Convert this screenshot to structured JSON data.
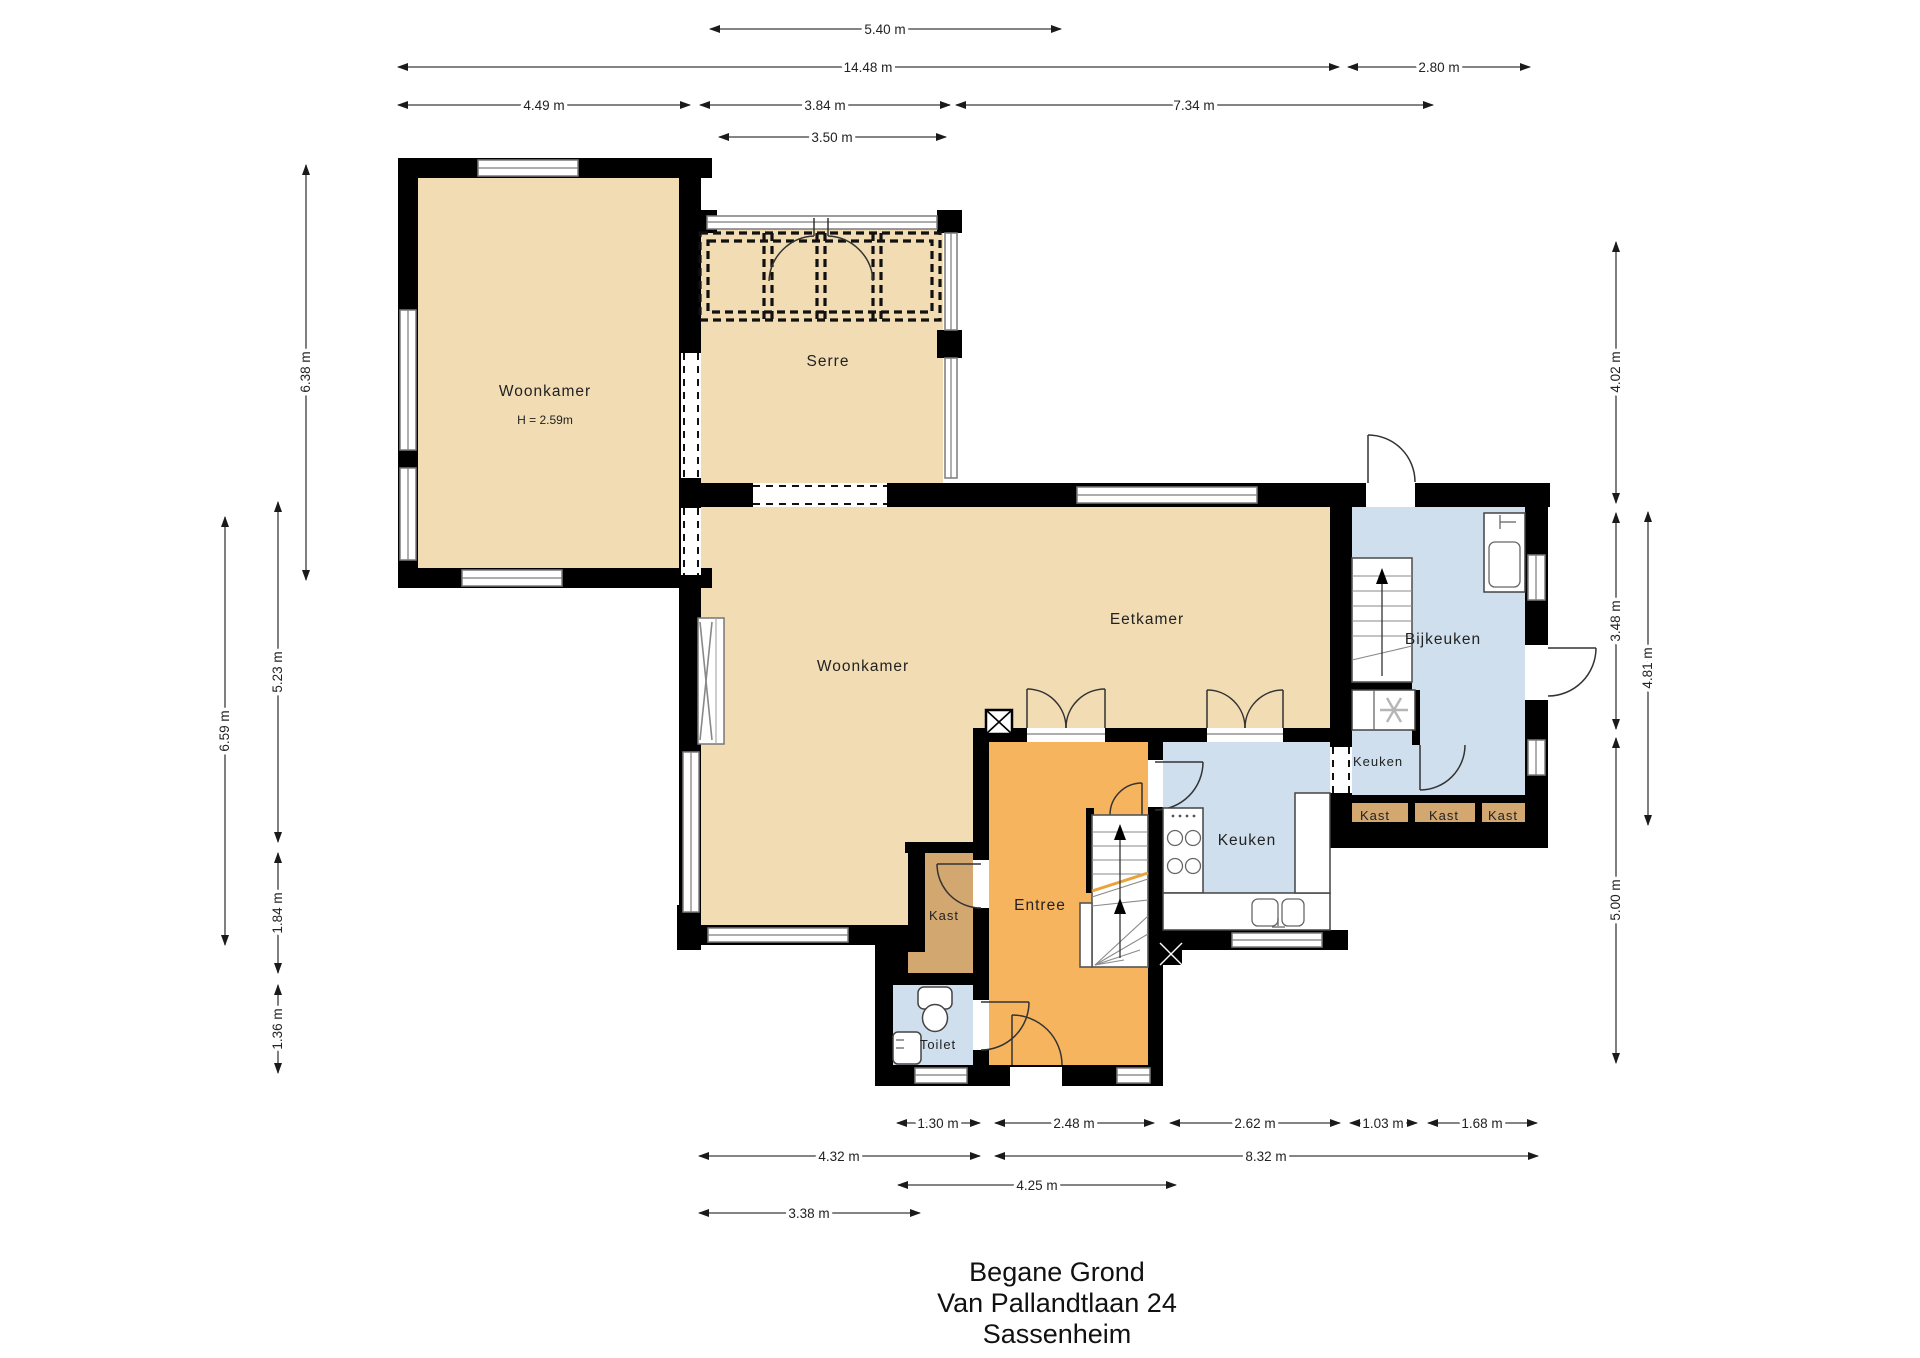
{
  "title": {
    "lines": [
      "Begane Grond",
      "Van Pallandtlaan 24",
      "Sassenheim"
    ]
  },
  "rooms": {
    "woonkamer_nw": {
      "label": "Woonkamer",
      "ceiling_height": "H = 2.59m"
    },
    "serre": {
      "label": "Serre"
    },
    "woonkamer": {
      "label": "Woonkamer"
    },
    "eetkamer": {
      "label": "Eetkamer"
    },
    "bijkeuken": {
      "label": "Bijkeuken"
    },
    "keuken_bij": {
      "label": "Keuken"
    },
    "keuken": {
      "label": "Keuken"
    },
    "entree": {
      "label": "Entree"
    },
    "kast": {
      "label": "Kast"
    },
    "toilet": {
      "label": "Toilet"
    },
    "kast_row": [
      {
        "label": "Kast"
      },
      {
        "label": "Kast"
      },
      {
        "label": "Kast"
      }
    ]
  },
  "dimensions": {
    "top": [
      {
        "label": "5.40 m"
      },
      {
        "label": "14.48 m"
      },
      {
        "label": "2.80 m"
      },
      {
        "label": "4.49 m"
      },
      {
        "label": "3.84 m"
      },
      {
        "label": "7.34 m"
      },
      {
        "label": "3.50 m"
      }
    ],
    "left": [
      {
        "label": "6.38 m"
      },
      {
        "label": "6.59 m"
      },
      {
        "label": "5.23 m"
      },
      {
        "label": "1.84 m"
      },
      {
        "label": "1.36 m"
      }
    ],
    "right": [
      {
        "label": "4.02 m"
      },
      {
        "label": "3.48 m"
      },
      {
        "label": "4.81 m"
      },
      {
        "label": "5.00 m"
      }
    ],
    "bottom": [
      {
        "label": "1.30 m"
      },
      {
        "label": "2.48 m"
      },
      {
        "label": "2.62 m"
      },
      {
        "label": "1.03 m"
      },
      {
        "label": "1.68 m"
      },
      {
        "label": "4.32 m"
      },
      {
        "label": "8.32 m"
      },
      {
        "label": "4.25 m"
      },
      {
        "label": "3.38 m"
      }
    ]
  },
  "colors": {
    "room-tan": "#f1dcb4",
    "room-orange": "#f6b45e",
    "room-blue": "#cfdfee",
    "room-brown": "#d2a870",
    "wall": "#000000",
    "dim-line": "#3a3a3a",
    "accent-stair-cut": "#e8a33d"
  }
}
